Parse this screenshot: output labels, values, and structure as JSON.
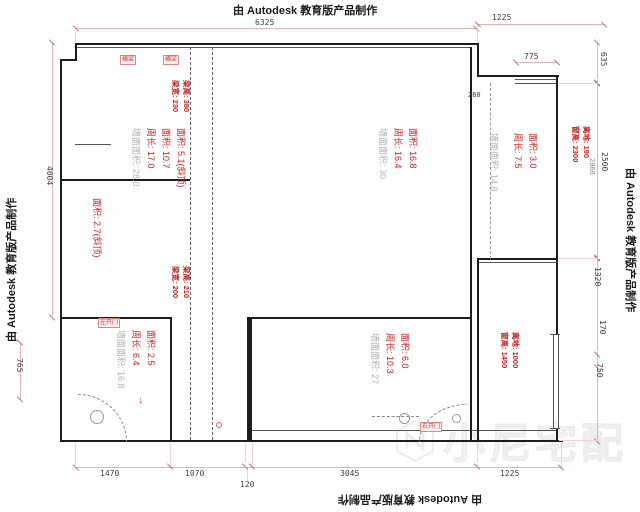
{
  "watermark": {
    "autodesk_text": "由 Autodesk 教育版产品制作",
    "logo_text": "小尼宅配"
  },
  "colors": {
    "wall": "#1c1c1c",
    "dim_line": "#e2b6b6",
    "dim_text": "#3d3d3d",
    "room_red": "#cc2020",
    "room_gray": "#b2b2b2",
    "tag_red": "#cc3333"
  },
  "dimensions": {
    "top_width": "6325",
    "top_right_width": "1225",
    "balcony_window_width": "775",
    "balcony_gap": "260",
    "right_top": "635",
    "right_mid": "2500",
    "right_extra": "2060",
    "right_lower_1": "1320",
    "right_lower_2": "170",
    "right_lower_3": "750",
    "left_height": "4004",
    "left_lower": "765",
    "bottom_1": "1470",
    "bottom_2": "1070",
    "bottom_3": "120",
    "bottom_4": "3045",
    "bottom_5": "1225"
  },
  "rooms": {
    "top_left": {
      "line1": "面积: 5.1(斜顶)",
      "line2": "面积: 10.7",
      "line3": "周长: 17.0",
      "line4": "墙面面积: 28.0"
    },
    "left_strip": {
      "line1": "面积: 2.7(斜顶)"
    },
    "bathroom": {
      "line1": "面积: 2.5",
      "line2": "周长: 6.4",
      "line3": "墙面面积: 16.8"
    },
    "central": {
      "line1": "面积: 16.8",
      "line2": "周长: 16.4",
      "line3": "墙面面积: 30"
    },
    "bottom_center": {
      "line1": "面积: 6.0",
      "line2": "周长: 10.3",
      "line3": "墙面面积: 27"
    },
    "balcony": {
      "line1": "面积: 3.0",
      "line2": "周长: 7.5",
      "line3": "墙面面积: 14.8"
    }
  },
  "beams": {
    "top": {
      "line1": "梁高: 380",
      "line2": "梁宽: 230"
    },
    "bottom": {
      "line1": "梁高: 210",
      "line2": "梁宽: 200"
    }
  },
  "windows": {
    "right_top": {
      "line1": "离地: 190",
      "line2": "窗高: 2300"
    },
    "right_bottom": {
      "line1": "离地: 1000",
      "line2": "窗高: 1450"
    }
  },
  "tags": {
    "beam_tag_1": "横梁",
    "beam_tag_2": "横梁",
    "bath_door": "左开门",
    "right_door": "右开门"
  },
  "symbols": {
    "down_arrow": "↓"
  }
}
